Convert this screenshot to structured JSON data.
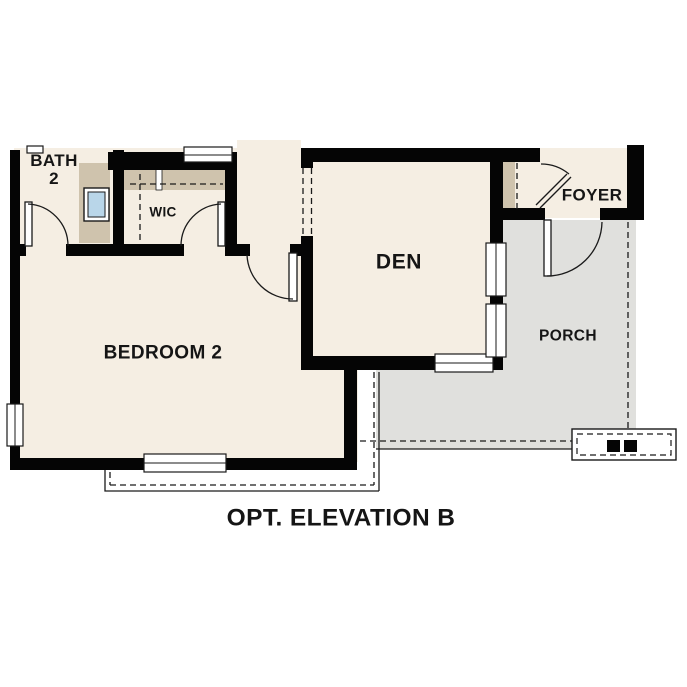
{
  "caption": "OPT. ELEVATION B",
  "rooms": {
    "bath_line1": "BATH",
    "bath_line2": "2",
    "wic": "WIC",
    "den": "DEN",
    "foyer": "FOYER",
    "porch": "PORCH",
    "bedroom": "BEDROOM 2"
  },
  "colors": {
    "floor": "#f5eee3",
    "cabinet": "#cfc3ad",
    "porch": "#e0e0dd",
    "sink": "#b9d6e9",
    "wall": "#050505",
    "line": "#1a1a1a"
  }
}
